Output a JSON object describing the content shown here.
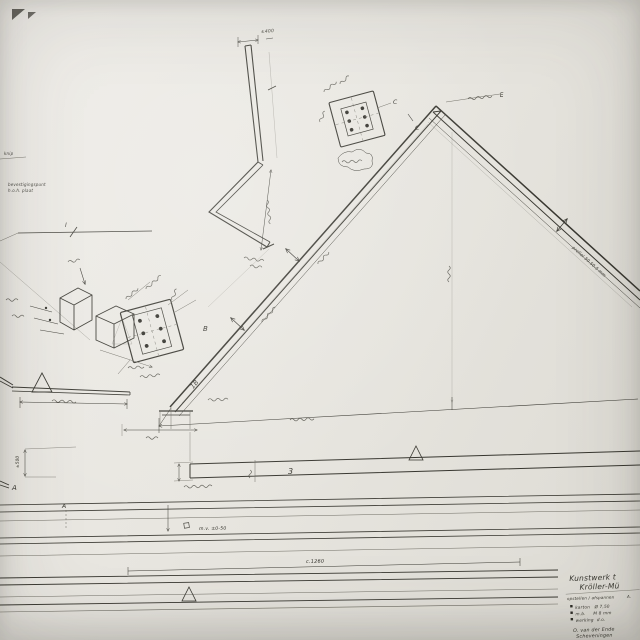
{
  "colors": {
    "paper": "#e8e6e0",
    "ink": "#37362f"
  },
  "labels": {
    "detail_a": "A",
    "detail_b": "B",
    "detail_c": "C",
    "beam_c": "C",
    "part_1b": "1B",
    "part_3": "3",
    "mark_i": "I",
    "mark_e": "E",
    "ground_a": "A"
  },
  "dimensions": {
    "mast_top": "±400",
    "height_left": "±500",
    "ground": "m.v. ±0-50",
    "row": "c.1260",
    "profile_right": "profiel 50.50.5 mm"
  },
  "annotations": {
    "fastening_1": "bevestigingspunt",
    "fastening_2": "h.o.h. plaat",
    "knip": "knip"
  },
  "title_block": {
    "line1": "Kunstwerk t",
    "line2": "Kröller-Mü",
    "subtitle": "opstellen / afspannen",
    "subtitle_right": "A.",
    "items": [
      "karton   Ø 7,50",
      "m.b.     M 8 mm",
      "werking  d.o."
    ],
    "footer_line1": "O. van der Ende",
    "footer_line2": "Scheveningen"
  }
}
